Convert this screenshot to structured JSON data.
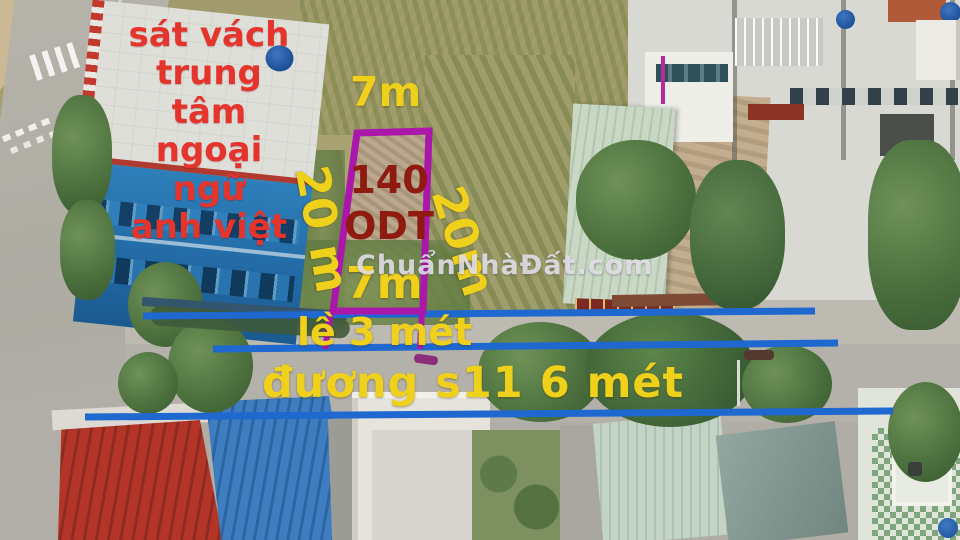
{
  "photo": {
    "watermark": "ChuẩnNhàĐất.com",
    "note": {
      "line1": "sát vách",
      "line2": "trung tâm",
      "line3": "ngoại ngữ",
      "line4": "anh việt"
    },
    "plot": {
      "width_top": "7m",
      "depth_left": "20 m",
      "depth_right": "20m",
      "lot_number": "140",
      "zoning": "ODT",
      "width_bottom": "7m"
    },
    "road": {
      "sidewalk_label": "lề 3 mét",
      "street_label": "đương s11 6 mét"
    },
    "colors": {
      "annotation_yellow": "#efd11c",
      "annotation_red": "#e5342c",
      "annotation_maroon": "#8e1a10",
      "plot_outline_purple": "#ab17ab",
      "road_line_blue": "#1e68d0"
    }
  }
}
